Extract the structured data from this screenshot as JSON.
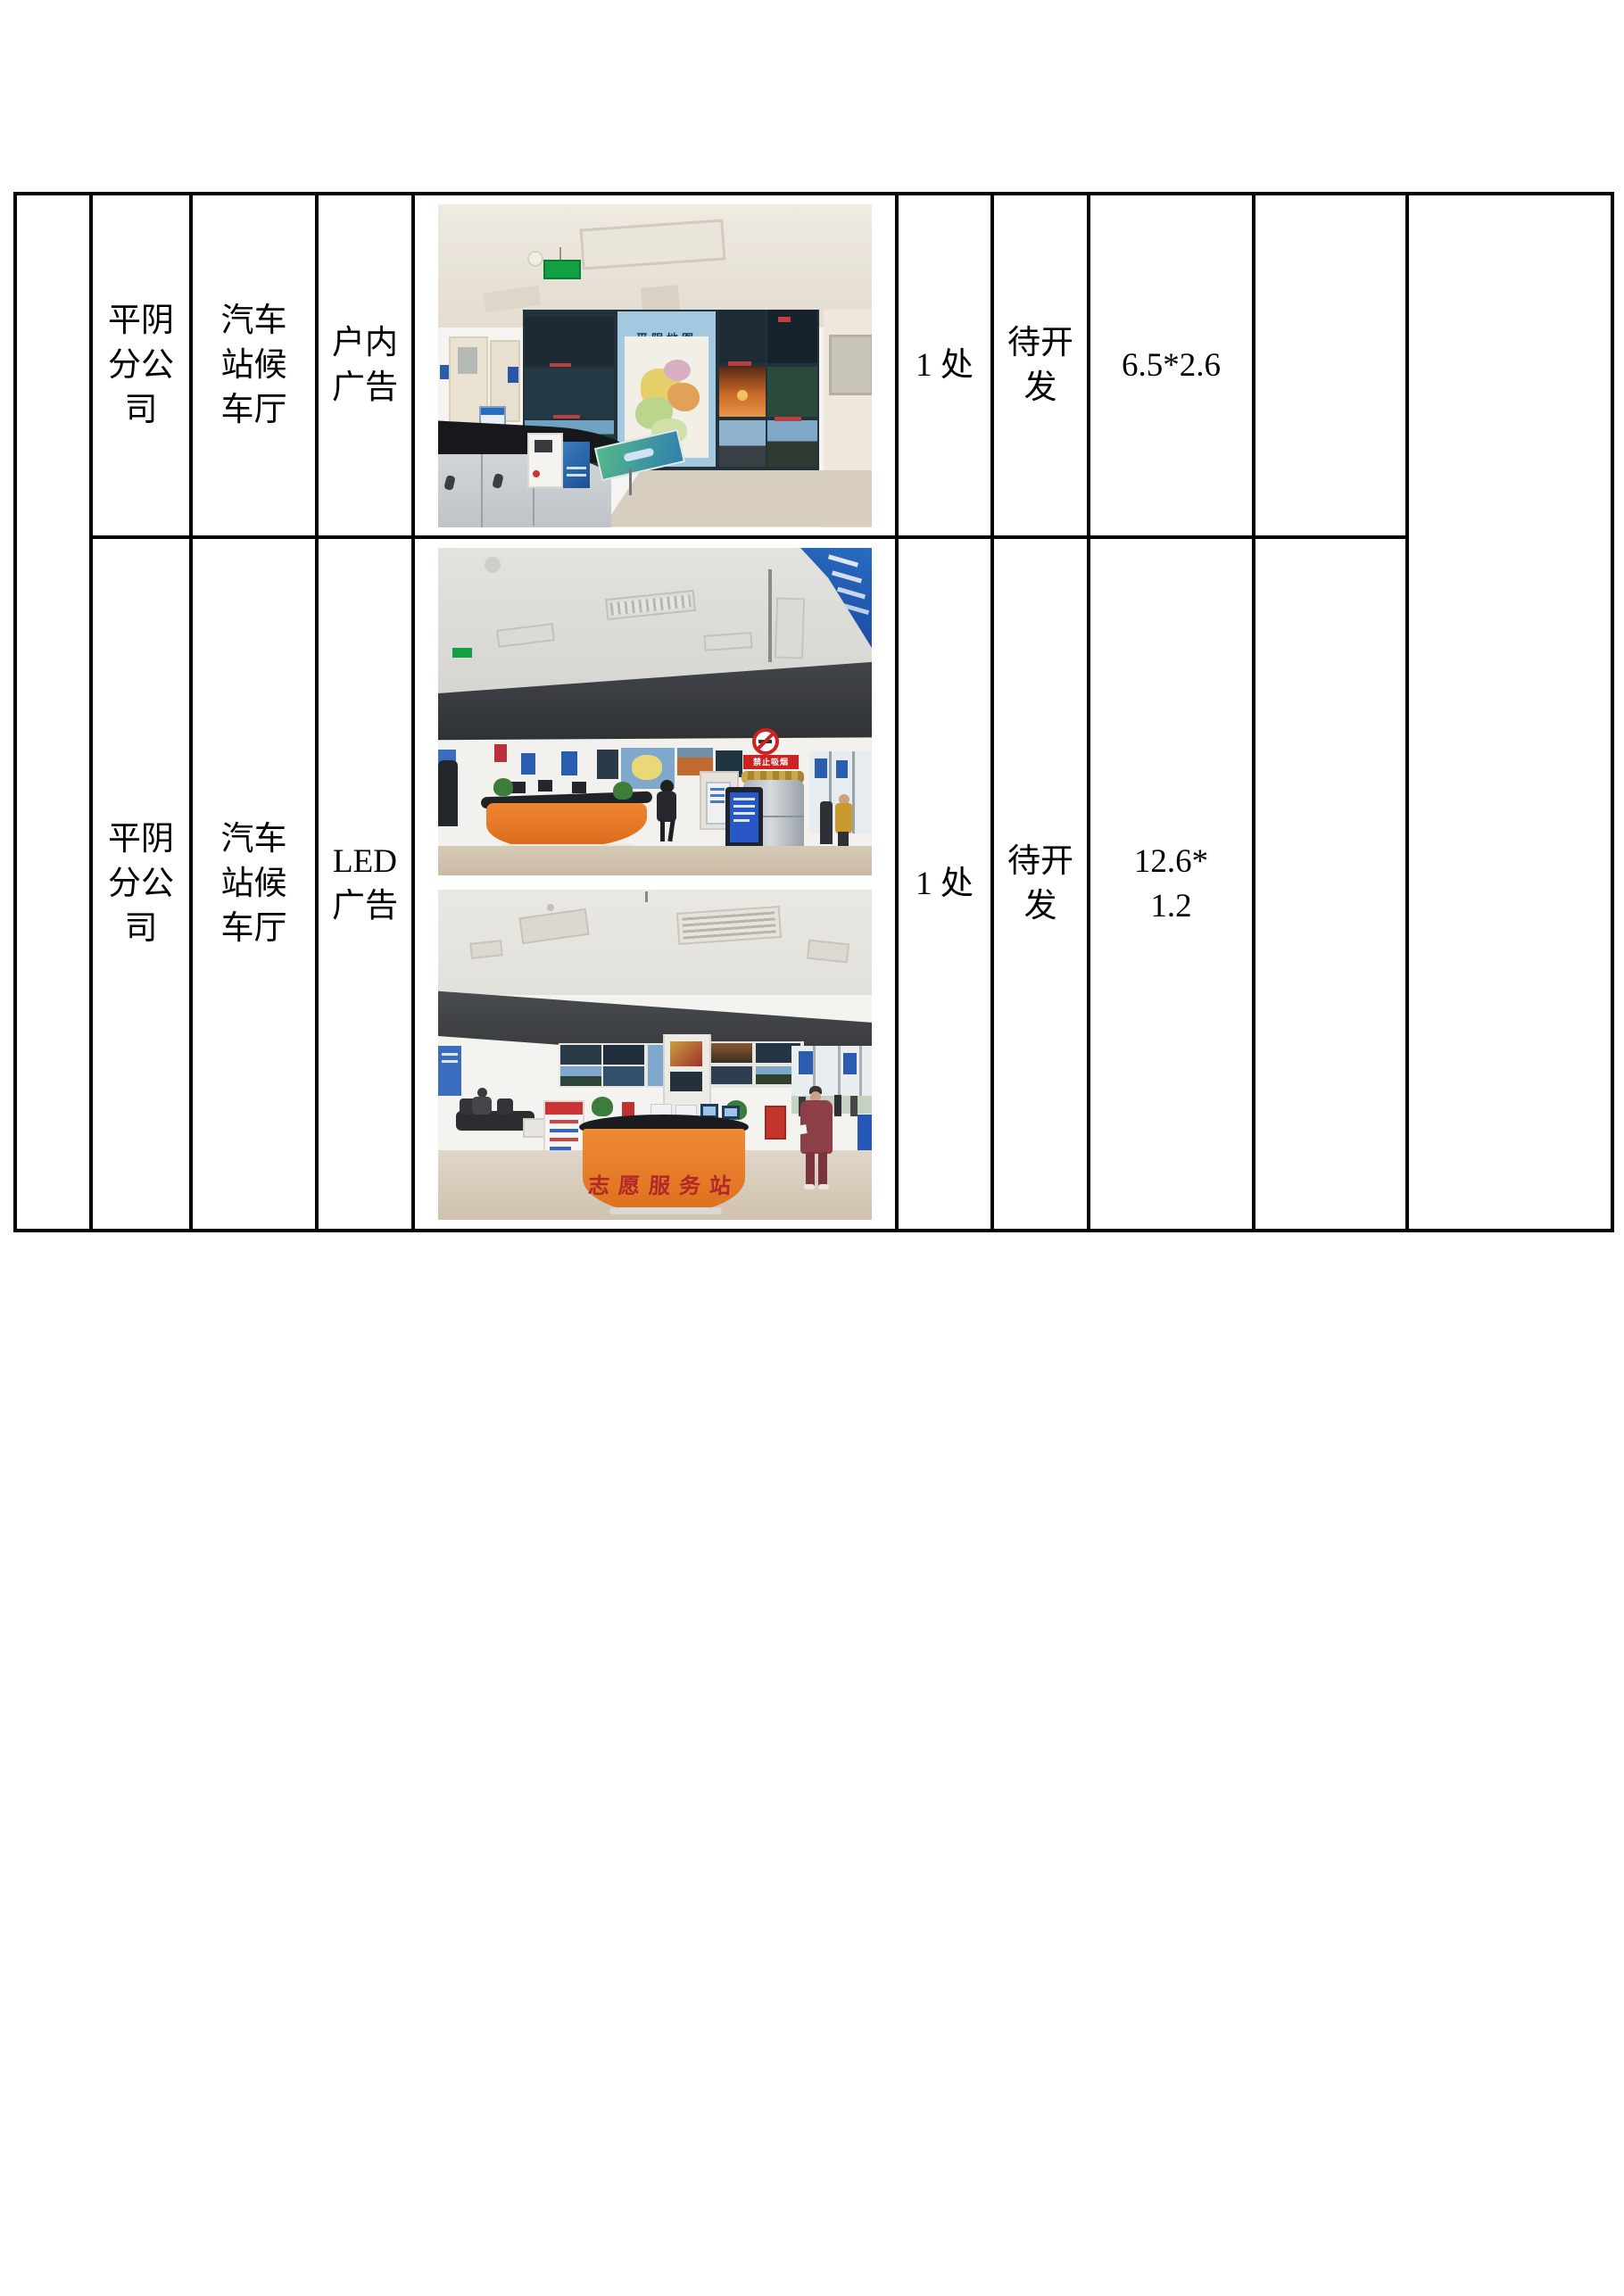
{
  "page": {
    "background": "#ffffff"
  },
  "table": {
    "border_color": "#000000",
    "rows": [
      {
        "branch": "平阴\n分公\n司",
        "location": "汽车\n站候\n车厅",
        "ad_type": "户内\n广告",
        "quantity": "1 处",
        "status": "待开\n发",
        "size": "6.5*2.6"
      },
      {
        "branch": "平阴\n分公\n司",
        "location": "汽车\n站候\n车厅",
        "ad_type": "LED\n广告",
        "quantity": "1 处",
        "status": "待开\n发",
        "size": "12.6*\n1.2"
      }
    ]
  },
  "photos": {
    "row1": {
      "map_title": "平阴地图"
    },
    "row2_top": {
      "no_smoking_label": "禁止吸烟"
    },
    "row2_bottom": {
      "desk_label": "志愿服务站"
    }
  },
  "colors": {
    "desk_orange": "#e87a28",
    "led_band_dark": "#3c3f43",
    "map_panel_blue": "#a3c9e0",
    "exit_sign_green": "#12a045",
    "warning_red": "#cc2222",
    "calligraphy_red": "#b02828",
    "counter_black": "#17181c"
  }
}
